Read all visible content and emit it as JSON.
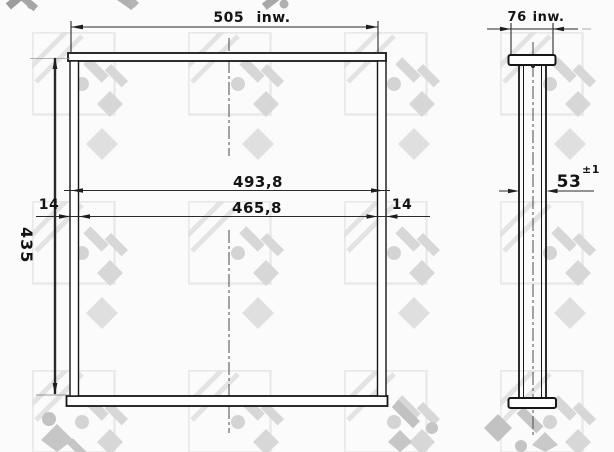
{
  "drawing": {
    "type": "technical-drawing",
    "watermark_text": "NRF",
    "front_view": {
      "dim_width_top": "505 inw.",
      "dim_width_core": "493,8",
      "dim_width_inner": "465,8",
      "dim_side_left": "14",
      "dim_side_right": "14",
      "dim_height": "435"
    },
    "side_view": {
      "dim_width_top": "76 inw.",
      "dim_thickness": "53",
      "dim_thickness_tolerance": "±1"
    },
    "colors": {
      "ink": "#1a1a1a",
      "background": "#fbfbfb",
      "watermark_light": "#e7e7e7",
      "watermark_mid": "#d6d6d6",
      "watermark_dark": "#b9b9b9"
    }
  }
}
